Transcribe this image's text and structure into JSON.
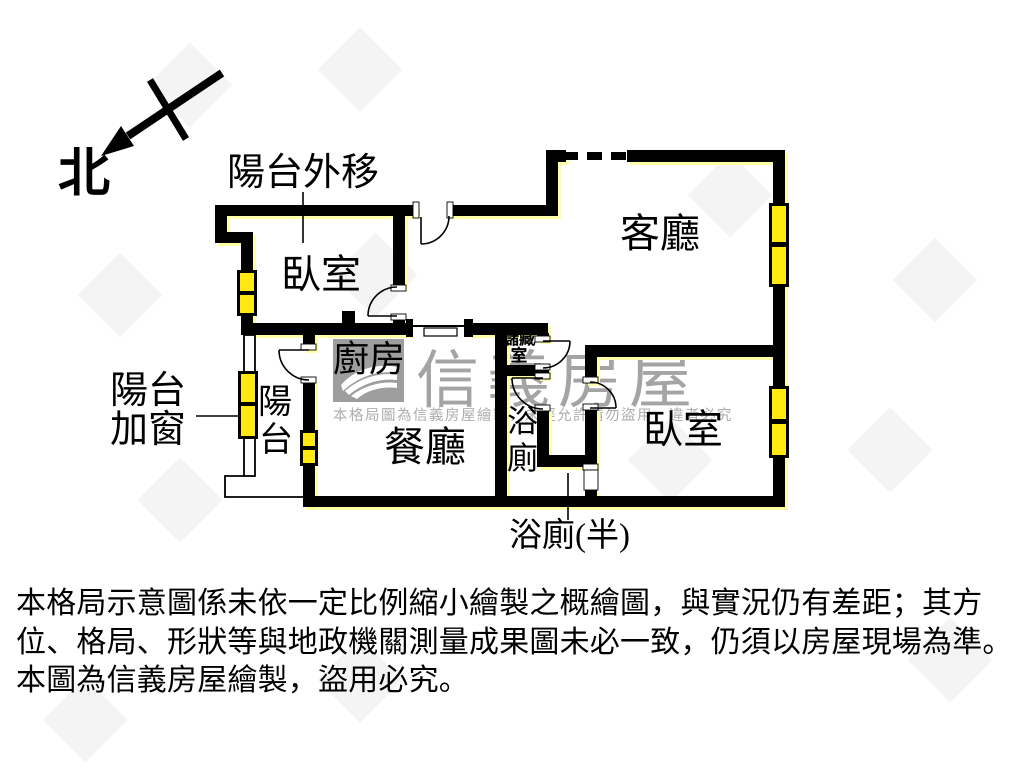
{
  "compass": {
    "label": "北"
  },
  "plan": {
    "rooms": {
      "living_room": "客廳",
      "bedroom_left": "臥室",
      "bedroom_right": "臥室",
      "kitchen": "廚房",
      "dining_room": "餐廳",
      "bathroom_chars": [
        "浴",
        "廁"
      ],
      "balcony_chars": [
        "陽",
        "台"
      ],
      "storage_lines": [
        "儲藏",
        "室"
      ]
    },
    "annotations": {
      "balcony_extended": "陽台外移",
      "balcony_added_window_lines": [
        "陽台",
        "加窗"
      ],
      "half_bathroom": "浴廁(半)"
    },
    "watermark": {
      "brand": "信義房屋",
      "notice": "本格局圖為信義房屋繪製，未經允許請勿盜用，違者必究"
    }
  },
  "disclaimer": {
    "line1": "本格局示意圖係未依一定比例縮小繪製之概繪圖，與實況仍有差距；其方",
    "line2": "位、格局、形狀等與地政機關測量成果圖未必一致，仍須以房屋現場為準。",
    "line3": "本圖為信義房屋繪製，盜用必究。"
  },
  "colors": {
    "wall": "#000000",
    "window_fill": "#ffe911",
    "wall_highlight": "#ffffa8",
    "watermark_gray": "#a4a4a4",
    "logo_gray": "#9e9e9e"
  }
}
